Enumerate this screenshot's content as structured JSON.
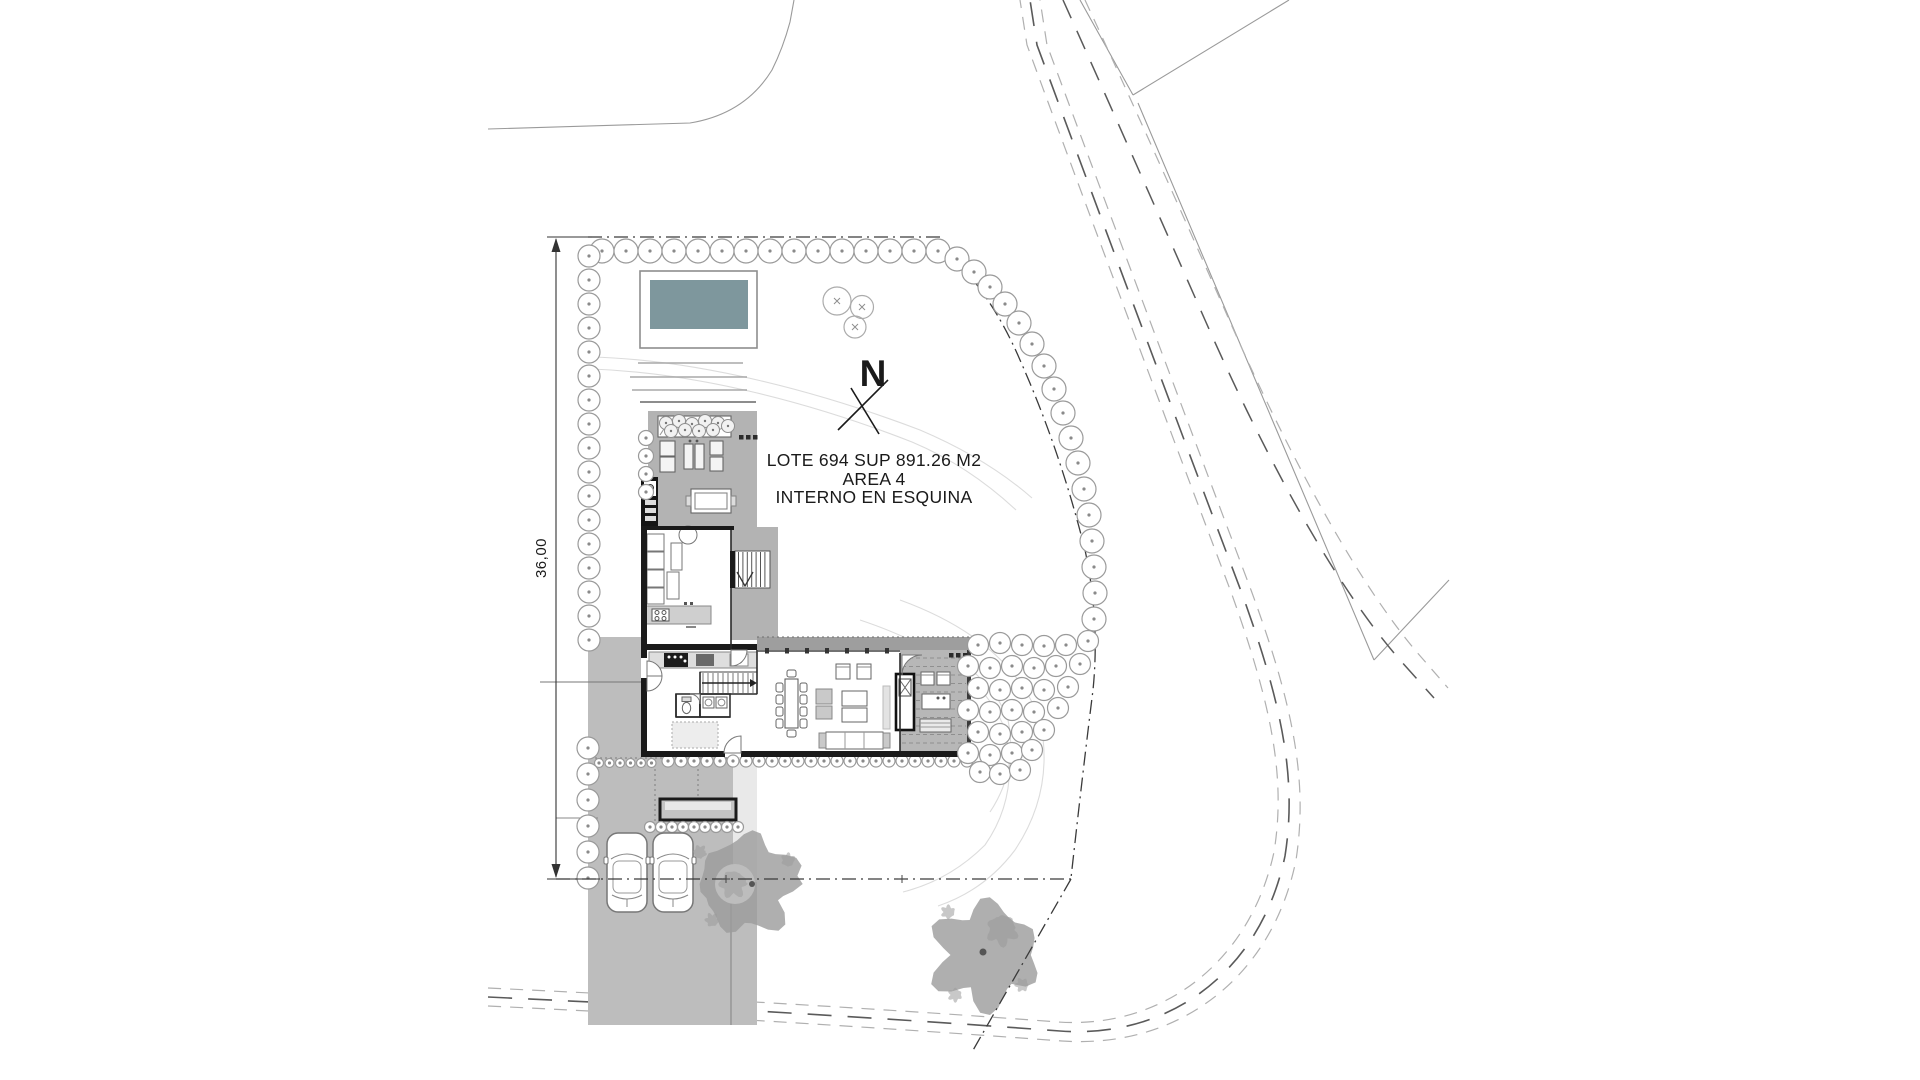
{
  "lot_label": {
    "line1": "LOTE 694 SUP 891.26 M2",
    "line2": "AREA 4",
    "line3": "INTERNO EN ESQUINA"
  },
  "north_arrow": {
    "label": "N"
  },
  "dimensions": {
    "west_side_length": "36,00"
  },
  "colors": {
    "pool_water": "#7E979D",
    "paving": "#bdbdbd",
    "terrace": "#b3b3b3",
    "deck": "#b7b7b7",
    "eave_band": "#9e9e9e",
    "wall": "#1a1a1a",
    "tree_stroke": "#9a9a9a",
    "tree_dot": "#8a8a8a",
    "canopy": "#9b9b9b",
    "boundary": "#3a3a3a",
    "road_dash_dark": "#5a5a5a",
    "road_dash_light": "#b0b0b0",
    "road_solid": "#9a9a9a",
    "contour": "#dcdcdc",
    "furniture_stroke": "#666666"
  }
}
